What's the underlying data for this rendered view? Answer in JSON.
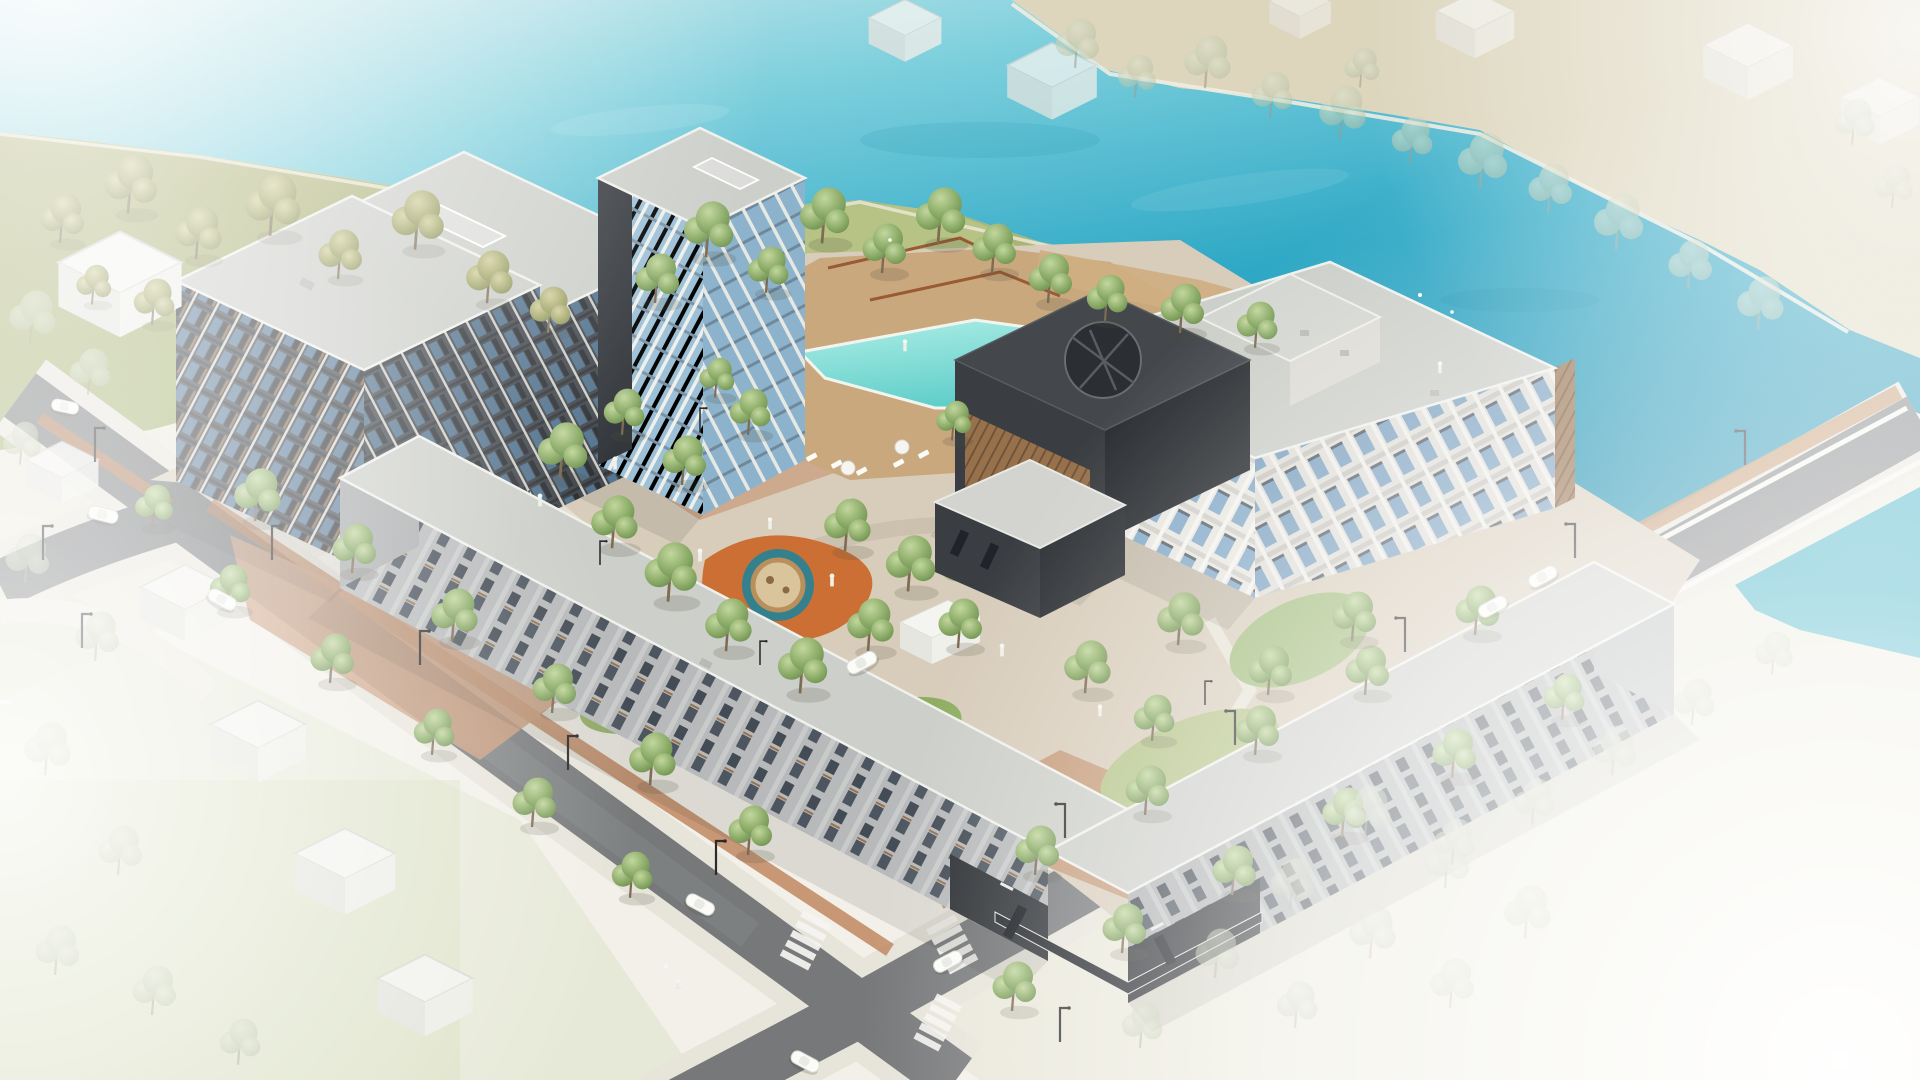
{
  "scene": {
    "type": "architectural-aerial-rendering",
    "title": "Waterfront residential complex — aerial axonometric rendering",
    "description": "Photorealistic-style axonometric site rendering of a mixed-height residential block beside a turquoise lake. Mid-rise dark-clad apartment bars and a glass tower frame an inner landscaped courtyard with a swimming pool, timber sun deck, playground and lawns. A low L-shaped rowhouse bar lines two perimeter streets with crosswalks, street lamps, white cars and street trees. A charcoal clubhouse with a circular roof oculus sits between the pool and a white 4-storey courtyard building at the waterfront. A road bridge crosses a canal at the right; schematic white context houses and trees fade to white at the image edges.",
    "water": {
      "lake": "large turquoise lake across the top of the image",
      "canal": "narrow canal strip right of the road bridge",
      "pool": "hexagonal turquoise swimming pool on a timber deck"
    },
    "buildings": [
      {
        "id": "west-apartment-bar-rear",
        "label": "8-storey apartment bar (rear, dark panel facade)"
      },
      {
        "id": "west-apartment-bar-front",
        "label": "8-storey apartment bar (front, dark panel facade)"
      },
      {
        "id": "central-tower",
        "label": "10-storey tower with white fins, glass and dark core"
      },
      {
        "id": "gray-link-block",
        "label": "3-storey light gray link block"
      },
      {
        "id": "east-courtyard-building",
        "label": "4-storey white waterfront courtyard building with penthouse level"
      },
      {
        "id": "clubhouse",
        "label": "charcoal clubhouse with circular roof oculus and timber-slat base"
      },
      {
        "id": "clubhouse-annex",
        "label": "single-storey dark annex pavilion"
      },
      {
        "id": "rowhouse-bar-west",
        "label": "2–3 storey rowhouse bar along the southwest street"
      },
      {
        "id": "rowhouse-bar-south",
        "label": "2–3 storey rowhouse bar along the southeast street"
      },
      {
        "id": "corner-storefront",
        "label": "dark corner storefront with canopy and illegible signage"
      }
    ],
    "amenities": [
      "swimming pool",
      "timber sun deck with loungers and umbrellas",
      "circular playground (orange / teal / sand, timber ring)",
      "yellow toddler play area",
      "lawns",
      "paved plaza paths",
      "white garden pavilion",
      "benches",
      "waterfront promenade"
    ],
    "infrastructure": [
      "two crossing perimeter streets",
      "road bridge over canal",
      "zebra crosswalks",
      "brick walkways",
      "street lamps",
      "white schematic cars",
      "one cyclist",
      "pedestrian figures"
    ],
    "context": [
      "white schematic gabled houses (left, bottom-left, top-right)",
      "far lake bank with faded trees",
      "tree grid fading to white at lower right",
      "white haze at image corners"
    ],
    "counts": {
      "cars": 9,
      "loungers": 9,
      "umbrellas": 2,
      "crosswalks": 3,
      "street_lamps": 14,
      "trees_approx": 90
    }
  },
  "palette": {
    "paper": "#f2f0e8",
    "waterHaze": "#d9edef",
    "waterLight": "#7fd0dd",
    "water": "#2fa9c6",
    "waterDeep": "#1b90b2",
    "canal": "#2aa7bf",
    "poolLight": "#aeeee6",
    "pool": "#5ecdc9",
    "bankBeige": "#ddd6bd",
    "bankGrass": "#b3b47c",
    "knoll": "#b7c687",
    "lawn": "#8fae62",
    "lawnPale": "#b6c489",
    "paver": "#d8cdbb",
    "paverPath": "#cbbfae",
    "brick": "#c08e63",
    "brickRed": "#b97a4f",
    "deck": "#c9a87e",
    "asphalt": "#76787a",
    "sidewalk": "#e7e4da",
    "roof": "#cdcfca",
    "parapet": "#f0f1ed",
    "facadeDark": "#4c5156",
    "panelDark": "#33373c",
    "glass": "#5d7e9c",
    "glassLight": "#86abc9",
    "facadeWhite": "#e9e7e1",
    "facadeGray": "#c7c7c3",
    "towerGlass": "#9dc0d6",
    "charcoal": "#3a3d41",
    "charcoalDeep": "#2b2e32",
    "wood": "#97714b",
    "playOrange": "#cc6f35",
    "playTeal": "#34808d",
    "playYellow": "#e7c550",
    "sand": "#d9c49c",
    "white": "#fbfbf8",
    "lamp": "#2b2b2b",
    "treeGreen": "#8fae6b",
    "treeOlive": "#a8ab6f"
  }
}
